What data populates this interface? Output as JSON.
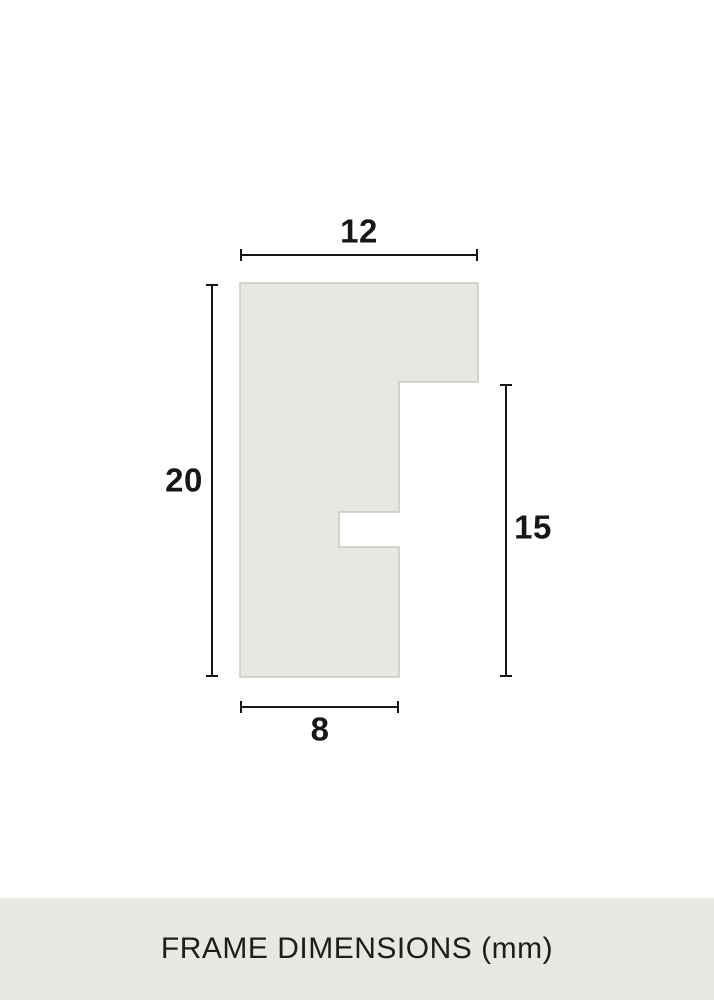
{
  "diagram": {
    "name": "frame-profile-cross-section",
    "unit": "mm",
    "dimensions": {
      "top_width": "12",
      "left_height": "20",
      "right_height": "15",
      "bottom_width": "8"
    }
  },
  "footer": {
    "caption": "FRAME DIMENSIONS (mm)"
  },
  "colors": {
    "background": "#ffffff",
    "shape_fill": "#e8e8e3",
    "shape_stroke": "#c9c9c3",
    "dimension_line": "#171717",
    "label_text": "#171717",
    "footer_background": "#e8e8e3",
    "footer_text": "#1d1d1b"
  }
}
